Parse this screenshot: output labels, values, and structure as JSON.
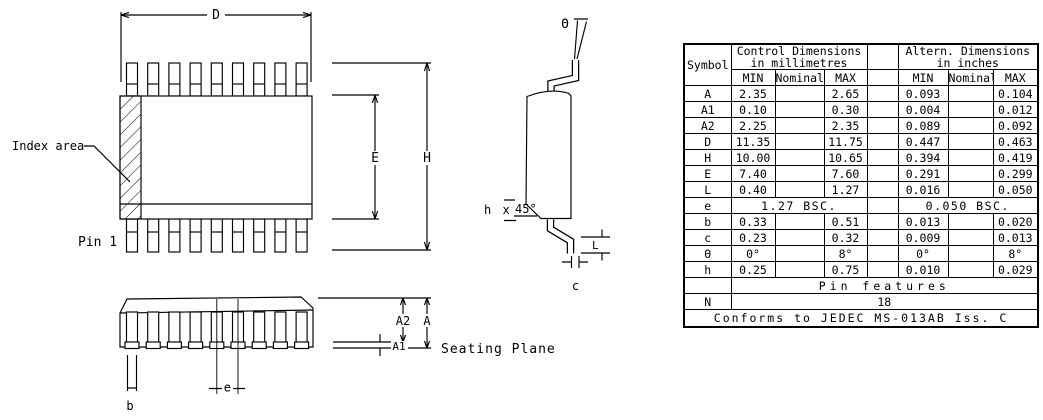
{
  "page": {
    "background_color": "#ffffff",
    "line_color": "#000000"
  },
  "drawing": {
    "top_view": {
      "dim_d": "D",
      "dim_e": "E",
      "dim_h": "H",
      "index_area_label": "Index area",
      "pin1_label": "Pin 1"
    },
    "side_view": {
      "theta": "Θ",
      "chamfer_prefix": "h x",
      "chamfer_angle": "45°",
      "dim_l": "L",
      "dim_c": "c"
    },
    "front_view": {
      "dim_a2": "A2",
      "dim_a": "A",
      "dim_a1": "A1",
      "dim_b": "b",
      "dim_e_pitch": "e",
      "seating_plane_label": "Seating Plane"
    }
  },
  "table": {
    "header": {
      "symbol": "Symbol",
      "control_title_line1": "Control Dimensions",
      "control_title_line2": "in millimetres",
      "altern_title_line1": "Altern. Dimensions",
      "altern_title_line2": "in inches",
      "min": "MIN",
      "nominal": "Nominal",
      "max": "MAX"
    },
    "rows": [
      {
        "symbol": "A",
        "mm_min": "2.35",
        "mm_nom": "",
        "mm_max": "2.65",
        "in_min": "0.093",
        "in_nom": "",
        "in_max": "0.104"
      },
      {
        "symbol": "A1",
        "mm_min": "0.10",
        "mm_nom": "",
        "mm_max": "0.30",
        "in_min": "0.004",
        "in_nom": "",
        "in_max": "0.012"
      },
      {
        "symbol": "A2",
        "mm_min": "2.25",
        "mm_nom": "",
        "mm_max": "2.35",
        "in_min": "0.089",
        "in_nom": "",
        "in_max": "0.092"
      },
      {
        "symbol": "D",
        "mm_min": "11.35",
        "mm_nom": "",
        "mm_max": "11.75",
        "in_min": "0.447",
        "in_nom": "",
        "in_max": "0.463"
      },
      {
        "symbol": "H",
        "mm_min": "10.00",
        "mm_nom": "",
        "mm_max": "10.65",
        "in_min": "0.394",
        "in_nom": "",
        "in_max": "0.419"
      },
      {
        "symbol": "E",
        "mm_min": "7.40",
        "mm_nom": "",
        "mm_max": "7.60",
        "in_min": "0.291",
        "in_nom": "",
        "in_max": "0.299"
      },
      {
        "symbol": "L",
        "mm_min": "0.40",
        "mm_nom": "",
        "mm_max": "1.27",
        "in_min": "0.016",
        "in_nom": "",
        "in_max": "0.050"
      }
    ],
    "e_row": {
      "symbol": "e",
      "mm": "1.27 BSC.",
      "in": "0.050 BSC."
    },
    "rows2": [
      {
        "symbol": "b",
        "mm_min": "0.33",
        "mm_nom": "",
        "mm_max": "0.51",
        "in_min": "0.013",
        "in_nom": "",
        "in_max": "0.020"
      },
      {
        "symbol": "c",
        "mm_min": "0.23",
        "mm_nom": "",
        "mm_max": "0.32",
        "in_min": "0.009",
        "in_nom": "",
        "in_max": "0.013"
      },
      {
        "symbol": "Θ",
        "mm_min": "0°",
        "mm_nom": "",
        "mm_max": "8°",
        "in_min": "0°",
        "in_nom": "",
        "in_max": "8°"
      },
      {
        "symbol": "h",
        "mm_min": "0.25",
        "mm_nom": "",
        "mm_max": "0.75",
        "in_min": "0.010",
        "in_nom": "",
        "in_max": "0.029"
      }
    ],
    "pin_features": {
      "label": "Pin features"
    },
    "n_row": {
      "symbol": "N",
      "value": "18"
    },
    "footer": "Conforms to JEDEC MS-013AB Iss. C"
  }
}
